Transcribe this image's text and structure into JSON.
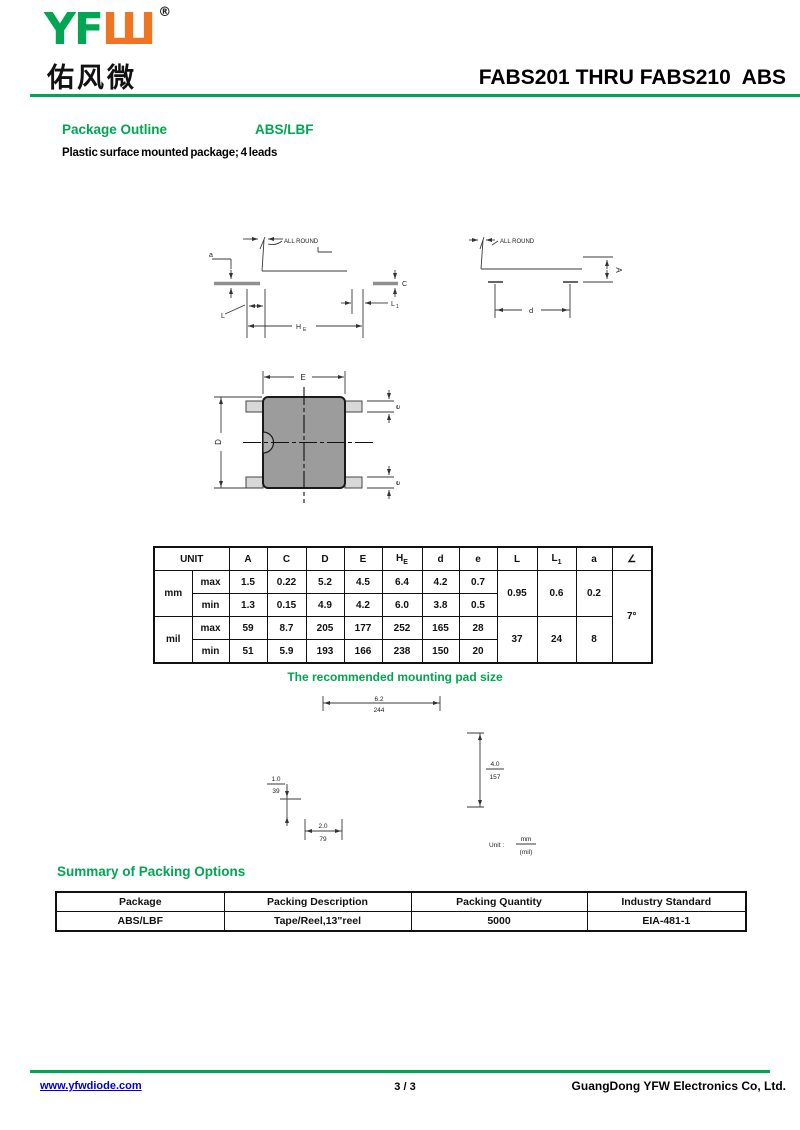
{
  "logo": {
    "yf": "YF",
    "w": "Ш",
    "registered": "®",
    "cn": "佑风微"
  },
  "header": {
    "title": "FABS201 THRU FABS210  ABS"
  },
  "section": {
    "heading": "Package Outline",
    "package": "ABS/LBF",
    "subtitle": "Plastic surface mounted package; 4 leads"
  },
  "drawings": {
    "all_round": "ALL ROUND",
    "a": "a",
    "L": "L",
    "L1_base": "L",
    "L1_sub": "1",
    "HE_base": "H",
    "HE_sub": "E",
    "C": "C",
    "A": "A",
    "d": "d",
    "E": "E",
    "D": "D",
    "e": "e"
  },
  "dim_table": {
    "unit": "UNIT",
    "max_label": "max",
    "min_label": "min",
    "headers": {
      "A": "A",
      "C": "C",
      "D": "D",
      "E": "E",
      "HE_base": "H",
      "HE_sub": "E",
      "d": "d",
      "e": "e",
      "L": "L",
      "L1_base": "L",
      "L1_sub": "1",
      "a": "a",
      "angle": "∠"
    },
    "mm": {
      "label": "mm",
      "max": [
        "1.5",
        "0.22",
        "5.2",
        "4.5",
        "6.4",
        "4.2",
        "0.7"
      ],
      "min": [
        "1.3",
        "0.15",
        "4.9",
        "4.2",
        "6.0",
        "3.8",
        "0.5"
      ],
      "L": "0.95",
      "L1": "0.6",
      "a": "0.2"
    },
    "mil": {
      "label": "mil",
      "max": [
        "59",
        "8.7",
        "205",
        "177",
        "252",
        "165",
        "28"
      ],
      "min": [
        "51",
        "5.9",
        "193",
        "166",
        "238",
        "150",
        "20"
      ],
      "L": "37",
      "L1": "24",
      "a": "8"
    },
    "angle_value": "7°"
  },
  "pad": {
    "heading": "The recommended mounting pad size",
    "width_mm": "6.2",
    "width_mil": "244",
    "height_mm": "4.0",
    "height_mil": "157",
    "pad_h_mm": "1.0",
    "pad_h_mil": "39",
    "pad_w_mm": "2.0",
    "pad_w_mil": "79",
    "unit_label": "Unit :",
    "unit_mm": "mm",
    "unit_mil": "(mil)"
  },
  "packing": {
    "heading": "Summary of Packing Options",
    "headers": [
      "Package",
      "Packing Description",
      "Packing Quantity",
      "Industry Standard"
    ],
    "row": [
      "ABS/LBF",
      "Tape/Reel,13\"reel",
      "5000",
      "EIA-481-1"
    ]
  },
  "footer": {
    "website": "www.yfwdiode.com",
    "page": "3 / 3",
    "company": "GuangDong YFW Electronics Co, Ltd."
  },
  "colors": {
    "green": "#00A651",
    "orange": "#EE7623",
    "link_blue": "#0000DD"
  }
}
